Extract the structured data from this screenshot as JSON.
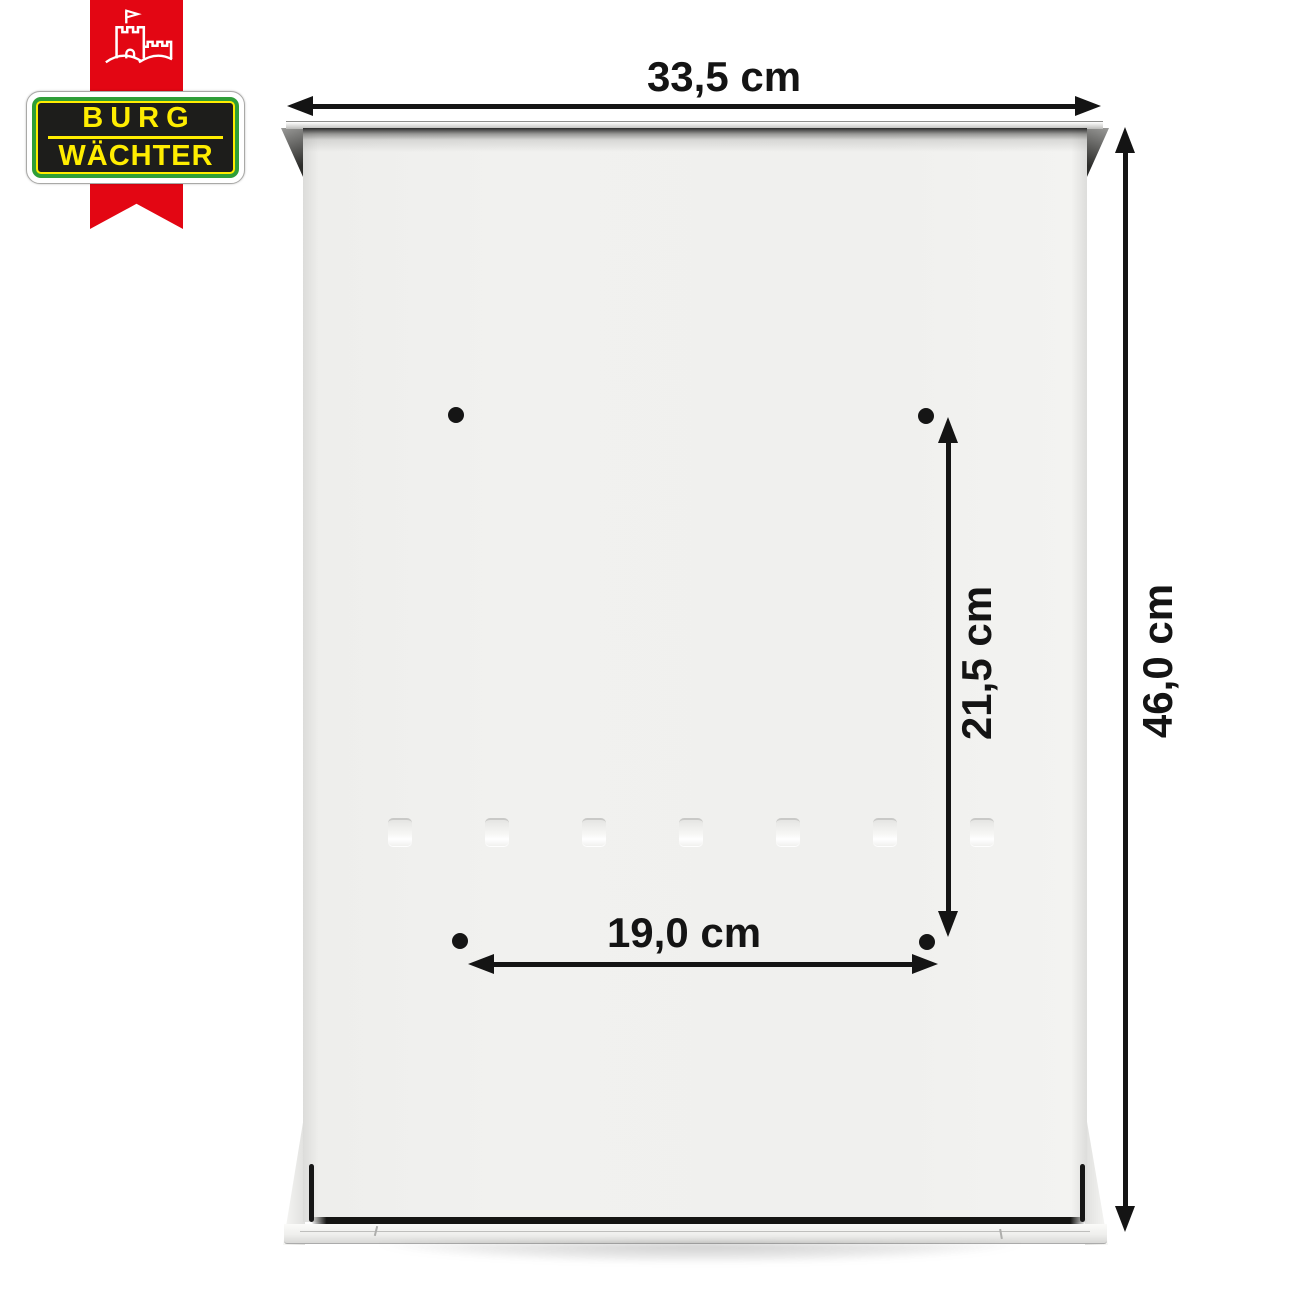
{
  "logo": {
    "line1": "BURG",
    "line2": "WÄCHTER",
    "icon": "castle-flag-icon",
    "colors": {
      "ribbon_red": "#e30613",
      "green": "#2f9e38",
      "yellow": "#ffed00",
      "black": "#1d1d1b"
    }
  },
  "dimensions": {
    "overall_width": "33,5 cm",
    "overall_height": "46,0 cm",
    "hole_spacing_vertical": "21,5 cm",
    "hole_spacing_horizontal": "19,0 cm"
  },
  "mounting_holes_count": 4,
  "vent_slots_count": 7
}
